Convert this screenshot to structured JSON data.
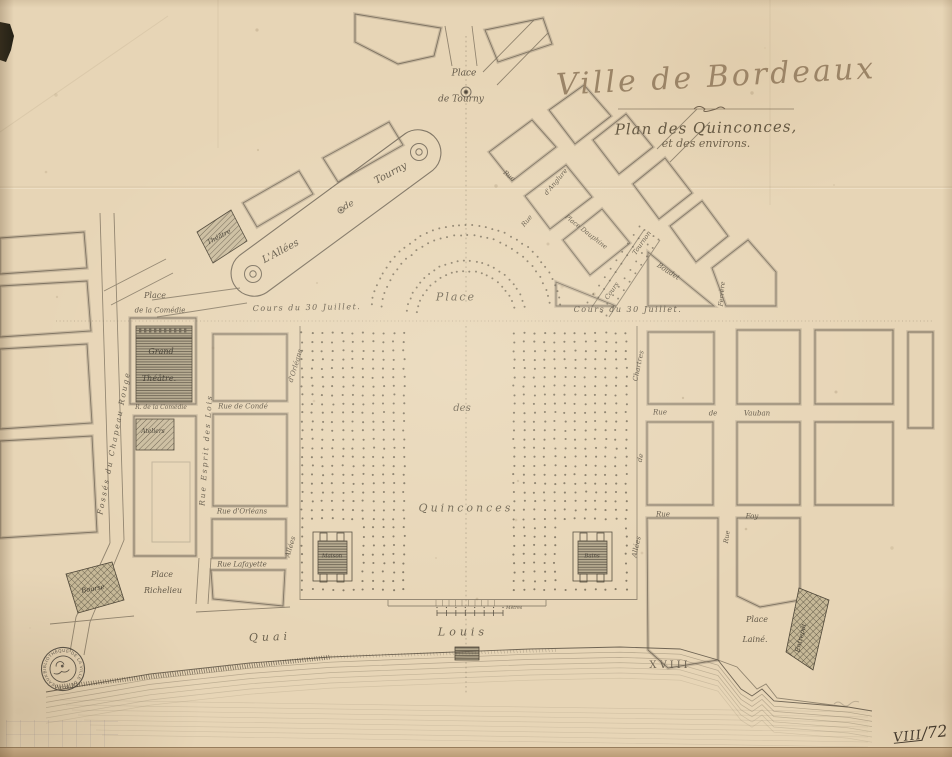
{
  "page": {
    "width": 952,
    "height": 757
  },
  "colors": {
    "paper": "#e7d5b6",
    "line_ink": "#7b7060",
    "dark_ink": "#4e4537",
    "building_hatch": "#6e6350",
    "title_ink": "#978064",
    "tree_dot": "#695f4e",
    "stamp_ink": "#403c35",
    "black_mark": "#141109"
  },
  "title": {
    "city": "Ville de Bordeaux",
    "line1": "Plan des Quinconces,",
    "line2": "et des environs."
  },
  "stamp": {
    "ring_text": "BIBLIOTHÈQUE DE LA VILLE DE BORDEAUX"
  },
  "annotations": {
    "shelfmark_roman": "VIII",
    "shelfmark_fraction": "/72",
    "bottom_mark": "GMP 361"
  },
  "scale_bar": {
    "label": "Mètres"
  },
  "map": {
    "labels": [
      {
        "t": "Place",
        "x": 464,
        "y": 74,
        "r": 0,
        "s": 9
      },
      {
        "t": "de Tourny",
        "x": 461,
        "y": 100,
        "r": 0,
        "s": 9
      },
      {
        "t": "Rue",
        "x": 509,
        "y": 176,
        "r": 38,
        "s": 6.5
      },
      {
        "t": "Rue",
        "x": 527,
        "y": 221,
        "r": -50,
        "s": 6.5
      },
      {
        "t": "d'Anglure",
        "x": 556,
        "y": 182,
        "r": -50,
        "s": 6.5
      },
      {
        "t": "Place Dauphine",
        "x": 586,
        "y": 232,
        "r": 38,
        "s": 6.5
      },
      {
        "t": "Boudet",
        "x": 668,
        "y": 272,
        "r": 33,
        "s": 7
      },
      {
        "t": "Ferrère",
        "x": 722,
        "y": 294,
        "r": -85,
        "s": 6.5
      },
      {
        "t": "Cours",
        "x": 612,
        "y": 291,
        "r": -55,
        "s": 6.5
      },
      {
        "t": "Tournon",
        "x": 642,
        "y": 243,
        "r": -55,
        "s": 6.5
      },
      {
        "t": "L'Allées",
        "x": 281,
        "y": 252,
        "r": -28,
        "s": 10
      },
      {
        "t": "de",
        "x": 349,
        "y": 206,
        "r": -28,
        "s": 9
      },
      {
        "t": "Tourny",
        "x": 391,
        "y": 174,
        "r": -28,
        "s": 10
      },
      {
        "t": "Théâtre",
        "x": 219,
        "y": 237,
        "r": -28,
        "s": 6.5,
        "cls": "bld"
      },
      {
        "t": "Place",
        "x": 155,
        "y": 296,
        "r": 0,
        "s": 8
      },
      {
        "t": "de la Comédie",
        "x": 160,
        "y": 311,
        "r": 0,
        "s": 7
      },
      {
        "t": "Grand",
        "x": 161,
        "y": 352,
        "r": 0,
        "s": 8,
        "cls": "bld"
      },
      {
        "t": "Théâtre.",
        "x": 159,
        "y": 379,
        "r": 0,
        "s": 8,
        "cls": "bld"
      },
      {
        "t": "R. de la Comédie",
        "x": 161,
        "y": 408,
        "r": 0,
        "s": 6
      },
      {
        "t": "Ateliers",
        "x": 153,
        "y": 432,
        "r": 0,
        "s": 6,
        "cls": "bld"
      },
      {
        "t": "Fossés du Chapeau Rouge",
        "x": 114,
        "y": 443,
        "r": -79,
        "s": 7.5,
        "sp": 2
      },
      {
        "t": "Rue Esprit des Lois",
        "x": 206,
        "y": 450,
        "r": -86,
        "s": 7.5,
        "sp": 2
      },
      {
        "t": "Place",
        "x": 162,
        "y": 575,
        "r": 0,
        "s": 8
      },
      {
        "t": "Richelieu",
        "x": 163,
        "y": 591,
        "r": 0,
        "s": 8
      },
      {
        "t": "Bourse",
        "x": 93,
        "y": 589,
        "r": -10,
        "s": 6.5,
        "cls": "bld"
      },
      {
        "t": "Rue de Condé",
        "x": 243,
        "y": 407,
        "r": 0,
        "s": 7
      },
      {
        "t": "Rue d'Orléans",
        "x": 242,
        "y": 512,
        "r": 0,
        "s": 7
      },
      {
        "t": "Rue Lafayette",
        "x": 242,
        "y": 565,
        "r": 0,
        "s": 7
      },
      {
        "t": "d'Orléans",
        "x": 296,
        "y": 366,
        "r": -73,
        "s": 7
      },
      {
        "t": "Allées",
        "x": 291,
        "y": 547,
        "r": -73,
        "s": 7
      },
      {
        "t": "Cours du 30 Juillet.",
        "x": 307,
        "y": 308,
        "r": -1,
        "s": 8,
        "sp": 1.5
      },
      {
        "t": "Cours du 30 Juillet.",
        "x": 628,
        "y": 310,
        "r": 0,
        "s": 8,
        "sp": 1.5
      },
      {
        "t": "Place",
        "x": 456,
        "y": 297,
        "r": 0,
        "s": 11,
        "sp": 2,
        "cls": "big"
      },
      {
        "t": "des",
        "x": 462,
        "y": 409,
        "r": 0,
        "s": 10,
        "cls": "big"
      },
      {
        "t": "Quinconces",
        "x": 466,
        "y": 508,
        "r": 0,
        "s": 11,
        "sp": 3,
        "cls": "big"
      },
      {
        "t": "Maison",
        "x": 332,
        "y": 557,
        "r": 0,
        "s": 5.5,
        "cls": "bld"
      },
      {
        "t": "Bains",
        "x": 592,
        "y": 557,
        "r": 0,
        "s": 5.5,
        "cls": "bld"
      },
      {
        "t": "Chartres",
        "x": 639,
        "y": 366,
        "r": -78,
        "s": 7
      },
      {
        "t": "de",
        "x": 641,
        "y": 458,
        "r": -78,
        "s": 7
      },
      {
        "t": "Allées",
        "x": 637,
        "y": 547,
        "r": -78,
        "s": 7
      },
      {
        "t": "Rue",
        "x": 660,
        "y": 413,
        "r": 0,
        "s": 7
      },
      {
        "t": "de",
        "x": 713,
        "y": 414,
        "r": 0,
        "s": 7
      },
      {
        "t": "Vauban",
        "x": 757,
        "y": 414,
        "r": 0,
        "s": 7
      },
      {
        "t": "Rue",
        "x": 663,
        "y": 515,
        "r": 0,
        "s": 7
      },
      {
        "t": "Foy",
        "x": 752,
        "y": 517,
        "r": 0,
        "s": 7
      },
      {
        "t": "Rue",
        "x": 727,
        "y": 537,
        "r": -82,
        "s": 6.5
      },
      {
        "t": "Place",
        "x": 757,
        "y": 620,
        "r": 0,
        "s": 8
      },
      {
        "t": "Lainé.",
        "x": 755,
        "y": 640,
        "r": 0,
        "s": 8
      },
      {
        "t": "Entrepôt",
        "x": 801,
        "y": 638,
        "r": -76,
        "s": 6.5,
        "cls": "bld"
      },
      {
        "t": "Quai",
        "x": 270,
        "y": 637,
        "r": -2,
        "s": 11,
        "sp": 4,
        "cls": "big"
      },
      {
        "t": "Louis",
        "x": 463,
        "y": 632,
        "r": 0,
        "s": 11,
        "sp": 4,
        "cls": "big"
      },
      {
        "t": "XVIII",
        "x": 670,
        "y": 666,
        "r": 0,
        "s": 10,
        "sp": 3,
        "cls": "rom"
      }
    ]
  }
}
